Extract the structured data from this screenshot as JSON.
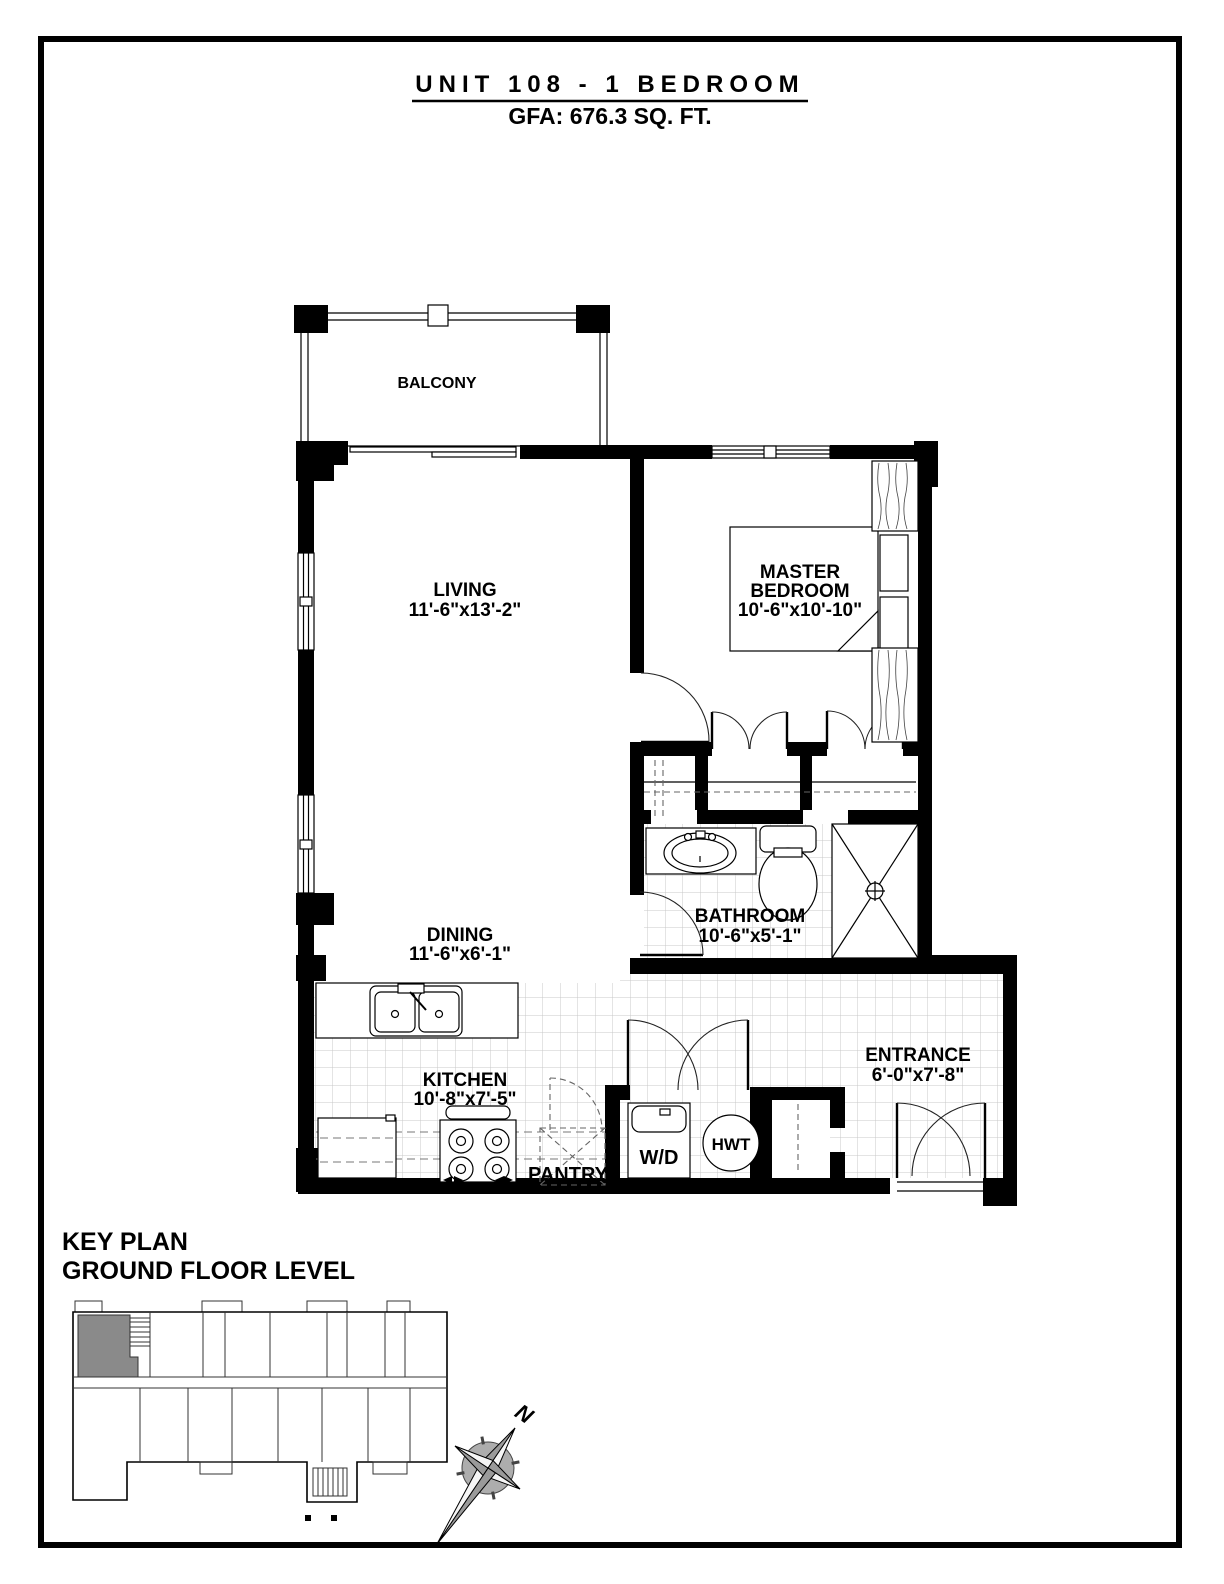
{
  "title": {
    "line1": "UNIT 108 - 1 BEDROOM",
    "line2": "GFA: 676.3 SQ. FT."
  },
  "rooms": {
    "balcony": {
      "name": "BALCONY"
    },
    "living": {
      "name": "LIVING",
      "dims": "11'-6\"x13'-2\""
    },
    "master_bedroom": {
      "line1": "MASTER",
      "line2": "BEDROOM",
      "dims": "10'-6\"x10'-10\""
    },
    "dining": {
      "name": "DINING",
      "dims": "11'-6\"x6'-1\""
    },
    "bathroom": {
      "name": "BATHROOM",
      "dims": "10'-6\"x5'-1\""
    },
    "kitchen": {
      "name": "KITCHEN",
      "dims": "10'-8\"x7'-5\""
    },
    "pantry": {
      "name": "PANTRY"
    },
    "entrance": {
      "name": "ENTRANCE",
      "dims": "6'-0\"x7'-8\""
    }
  },
  "fixtures": {
    "washer_dryer": "W/D",
    "hot_water_tank": "HWT"
  },
  "key_plan": {
    "title": "KEY PLAN",
    "subtitle": "GROUND FLOOR LEVEL"
  },
  "compass": {
    "north": "N"
  },
  "colors": {
    "wall": "#000000",
    "tile_line": "#c8c8c8",
    "highlight_unit": "#8a8a8a",
    "paper": "#ffffff"
  }
}
